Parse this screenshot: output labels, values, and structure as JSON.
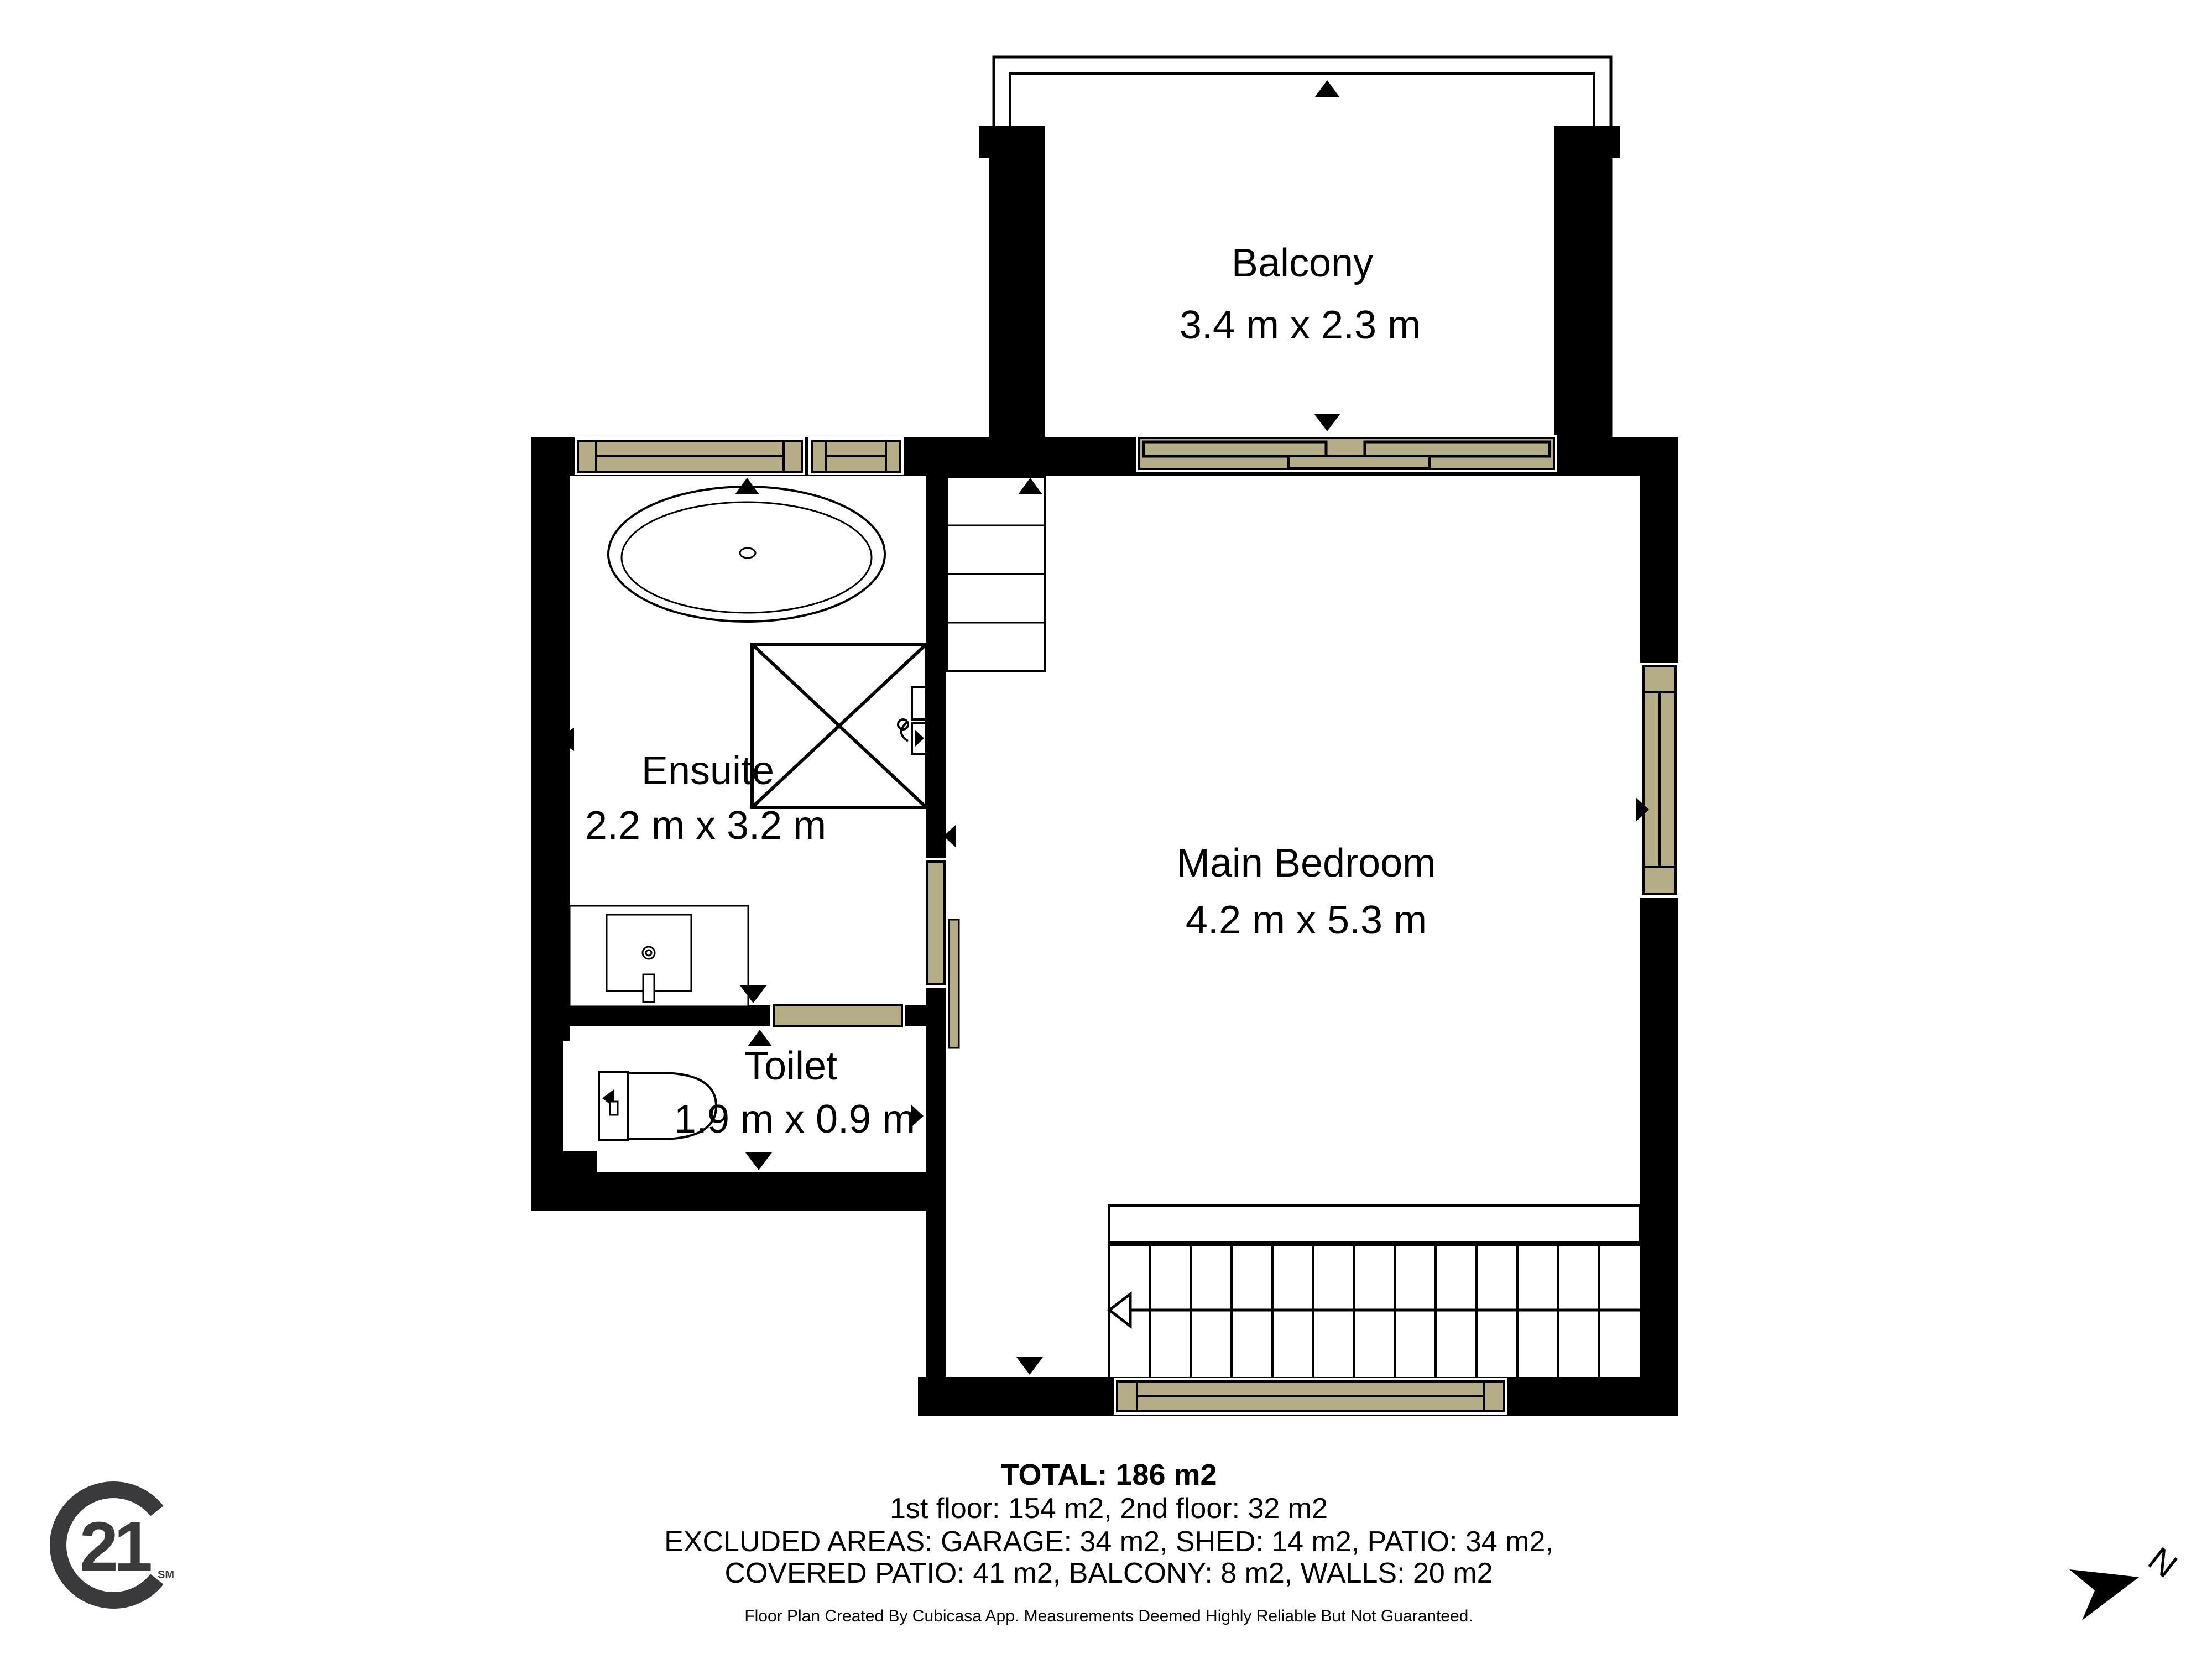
{
  "rooms": [
    {
      "name": "Balcony",
      "dims": "3.4 m x 2.3 m"
    },
    {
      "name": "Ensuite",
      "dims": "2.2 m x 3.2 m"
    },
    {
      "name": "Main Bedroom",
      "dims": "4.2 m x 5.3 m"
    },
    {
      "name": "Toilet",
      "dims": "1.9 m x 0.9 m"
    }
  ],
  "footer": {
    "total": "TOTAL: 186 m2",
    "floors": "1st floor: 154 m2, 2nd floor: 32 m2",
    "excluded_1": "EXCLUDED AREAS: GARAGE: 34 m2, SHED: 14 m2, PATIO: 34 m2,",
    "excluded_2": "COVERED PATIO: 41 m2, BALCONY: 8 m2, WALLS: 20 m2",
    "disclaimer": "Floor Plan Created By Cubicasa App. Measurements Deemed Highly Reliable But Not Guaranteed."
  },
  "branding": {
    "logo_number": "21",
    "logo_service_mark": "SM"
  },
  "compass": {
    "north_label": "N"
  },
  "colors": {
    "wall": "#000000",
    "window_fill": "#b4ac87",
    "background": "#ffffff",
    "logo_gray": "#3a3a3c"
  }
}
